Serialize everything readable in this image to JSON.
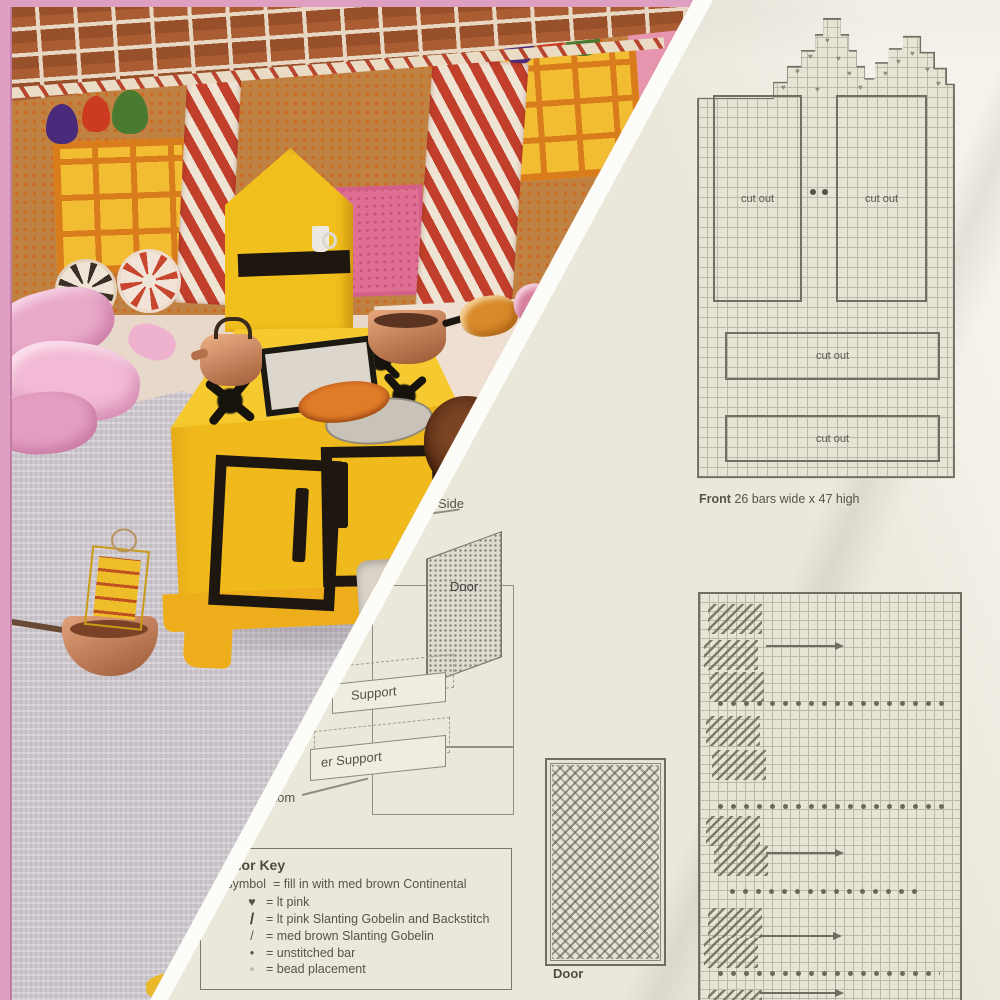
{
  "scan": {
    "front_chart": {
      "cutouts": [
        "cut out",
        "cut out",
        "cut out",
        "cut out"
      ],
      "caption_name": "Front",
      "caption_dims": "26 bars wide x 47 high",
      "heart": "♥"
    },
    "assembly": {
      "side": "Side",
      "door": "Door",
      "support_upper": "Support",
      "support_lower": "er Support",
      "bottom": "Bottom"
    },
    "door_chart": {
      "label": "Door"
    },
    "key": {
      "title": "Color Key",
      "entries": [
        {
          "sym": "no symbol",
          "txt": "= fill in with med brown Continental"
        },
        {
          "sym": "♥",
          "txt": "= lt pink"
        },
        {
          "sym": "/",
          "txt": "= lt pink Slanting Gobelin and Backstitch"
        },
        {
          "sym": "/",
          "txt": "= med brown Slanting Gobelin"
        },
        {
          "sym": "•",
          "txt": "= unstitched bar"
        },
        {
          "sym": "◦",
          "txt": "= bead placement"
        }
      ]
    },
    "colors": {
      "paper": "#ebe8db",
      "grid_line": "#bcb8a9",
      "outline": "#716e62",
      "text": "#56534a"
    }
  },
  "photo": {
    "colors": {
      "frame_pink": "#de9fc0",
      "roof_brick": "#98502a",
      "wall_tan": "#bf8243",
      "candy_red": "#c2402b",
      "window_yellow": "#f3bd33",
      "door_pink": "#df7094",
      "stove_yellow": "#f2c01d",
      "backdrop_pink": "#e794ae",
      "cloth_gray": "#cdc7cd"
    }
  }
}
